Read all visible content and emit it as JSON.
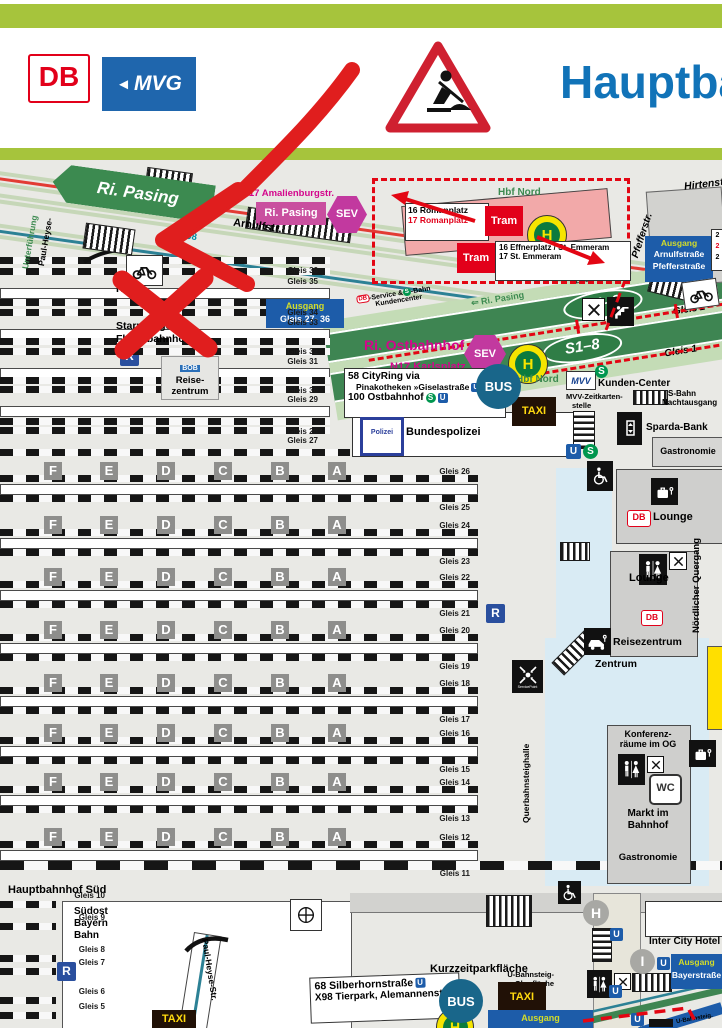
{
  "header": {
    "db": "DB",
    "mvg": "MVG",
    "title": "Hauptbahnhof"
  },
  "icons": {
    "u": "U",
    "s": "S",
    "h": "H",
    "r": "R",
    "i": "I",
    "wc": "WC",
    "db": "DB",
    "bus": "BUS",
    "taxi": "TAXI",
    "tram": "Tram",
    "sev": "SEV",
    "bob": "BOB",
    "mvv": "MVV",
    "polizei": "Polizei"
  },
  "marker": {
    "type": "hand-drawn arrow and cross",
    "color": "#e01e1e"
  },
  "nw": {
    "ri_pasing": "Ri. Pasing",
    "paul_heyse": "Paul-Heyse-",
    "unterfuehrung": "Unterführung",
    "n17": "N17 Amalienburgstr.",
    "ri_pasing_pink": "Ri. Pasing",
    "arnulfstr": "Arnulfstr.",
    "x98": "X98"
  },
  "trambox": {
    "hbf_nord": "Hbf Nord",
    "r16": "16 Romanplatz",
    "r17": "17 Romanplatz",
    "e16": "16 Effnerplatz / St. Emmeram",
    "e17": "17 St. Emmeram"
  },
  "ne": {
    "hirtenstr": "Hirtenstr.",
    "pfefferstr": "Pfefferstr.",
    "ausgang": "Ausgang",
    "l1": "Arnulfstraße",
    "l2": "Pfefferstraße",
    "n1": "2",
    "n2": "2",
    "n3": "2"
  },
  "sband": {
    "s18": "S1–8",
    "gleis2": "Gleis 2",
    "gleis1": "Gleis 1",
    "ri_pasing": "⇐ Ri. Pasing",
    "zw1": "S-Bahnsteig-",
    "zw2": "Zwischengeschoss-",
    "kc1": "-Service & ",
    "kc2": "-Bahn",
    "kc3": "Kundencenter"
  },
  "west": {
    "hbf": "Hbf",
    "starnberger": "Starnberger",
    "fluegel": "Flügelbahnhof",
    "reise": "Reise-",
    "zentrum": "zentrum",
    "ausgang": "Ausgang",
    "range": "Gleis 27- 36",
    "tracks": [
      [
        "Gleis 36",
        266
      ],
      [
        "Gleis 35",
        277
      ],
      [
        "Gleis 34",
        308
      ],
      [
        "Gleis 33",
        318
      ],
      [
        "Gleis 32",
        347
      ],
      [
        "Gleis 31",
        357
      ],
      [
        "Gleis 30",
        386
      ],
      [
        "Gleis 29",
        395
      ],
      [
        "Gleis 28",
        427
      ],
      [
        "Gleis 27",
        436
      ]
    ]
  },
  "center": {
    "ri_ost": "Ri. Ostbahnhof",
    "n17k": "N17 Karlsplatz",
    "cr1": "58 CityRing via",
    "cr2": "Pinakotheken »Giselastraße",
    "cr3": "100 Ostbahnhof",
    "hbf_nord": "Hbf Nord",
    "kunden": "Kunden-Center",
    "zeitk": "MVV-Zeitkarten-",
    "stelle": "stelle",
    "sbahn": "S-Bahn",
    "nacht": "Nachtausgang",
    "bundespolizei": "Bundespolizei",
    "sparda": "Sparda-Bank",
    "gastronomie": "Gastronomie"
  },
  "east": {
    "lounge": "Lounge",
    "quergang": "Nördlicher Quergang",
    "reisezentrum": "Reisezentrum",
    "zentrum": "Zentrum",
    "konf1": "Konferenz-",
    "konf2": "räume im OG",
    "markt1": "Markt im",
    "markt2": "Bahnhof",
    "gastronomie": "Gastronomie",
    "servicepoint": "ServicePoint",
    "halle": "Querbahnsteighalle"
  },
  "hall": {
    "letters": [
      "F",
      "E",
      "D",
      "C",
      "B",
      "A"
    ],
    "letter_x": [
      44,
      100,
      157,
      214,
      271,
      328
    ],
    "rows": [
      462,
      516,
      568,
      621,
      674,
      724,
      773,
      828
    ],
    "gleis_pairs": [
      [
        "Gleis 26",
        "Gleis 25"
      ],
      [
        "Gleis 24",
        "Gleis 23"
      ],
      [
        "Gleis 22",
        "Gleis 21"
      ],
      [
        "Gleis 20",
        "Gleis 19"
      ],
      [
        "Gleis 18",
        "Gleis 17"
      ],
      [
        "Gleis 16",
        "Gleis 15"
      ],
      [
        "Gleis 14",
        "Gleis 13"
      ],
      [
        "Gleis 12",
        "Gleis 11"
      ]
    ]
  },
  "south": {
    "title": "Hauptbahnhof Süd",
    "l1": "Südost",
    "l2": "Bayern",
    "l3": "Bahn",
    "tracks": [
      [
        "Gleis 10",
        891
      ],
      [
        "Gleis 9",
        913
      ],
      [
        "Gleis 8",
        945
      ],
      [
        "Gleis 7",
        958
      ],
      [
        "Gleis 6",
        987
      ],
      [
        "Gleis 5",
        1002
      ]
    ],
    "paul_heyse": "Paul-Heyse-Str.",
    "kurzzeit": "Kurzzeitparkfläche",
    "ub1": "U-Bahnsteig-",
    "ub2": "Oberfläche",
    "bus1": "68 Silberhornstraße",
    "bus2": "X98 Tierpark, Alemannenstr.",
    "ausgang": "Ausgang",
    "hotel": "Inter City Hotel",
    "ab1": "Ausgang",
    "ab2": "Bayerstraße",
    "ubs": "U-Bahnsteig."
  }
}
